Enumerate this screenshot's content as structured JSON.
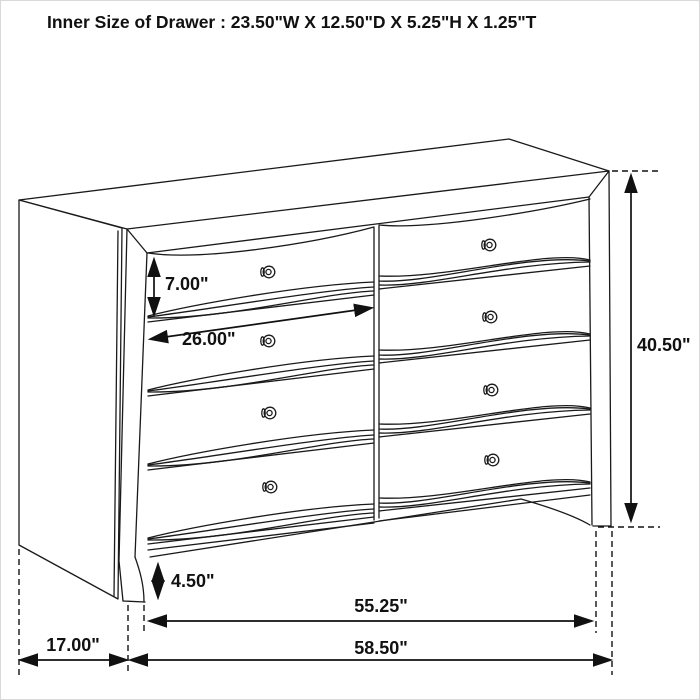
{
  "title": "Inner Size of Drawer : 23.50\"W X 12.50\"D X 5.25\"H X 1.25\"T",
  "diagram": {
    "subject": "8-drawer dresser line drawing with dimension annotations",
    "dimensions": {
      "drawer_front_height": "7.00\"",
      "drawer_front_width": "26.00\"",
      "overall_height": "40.50\"",
      "base_foot_height": "4.50\"",
      "leg_to_leg_width": "55.25\"",
      "overall_width": "58.50\"",
      "overall_depth": "17.00\""
    }
  },
  "colors": {
    "line": "#1a1a1a",
    "dimension_line": "#111111",
    "background": "#ffffff"
  }
}
